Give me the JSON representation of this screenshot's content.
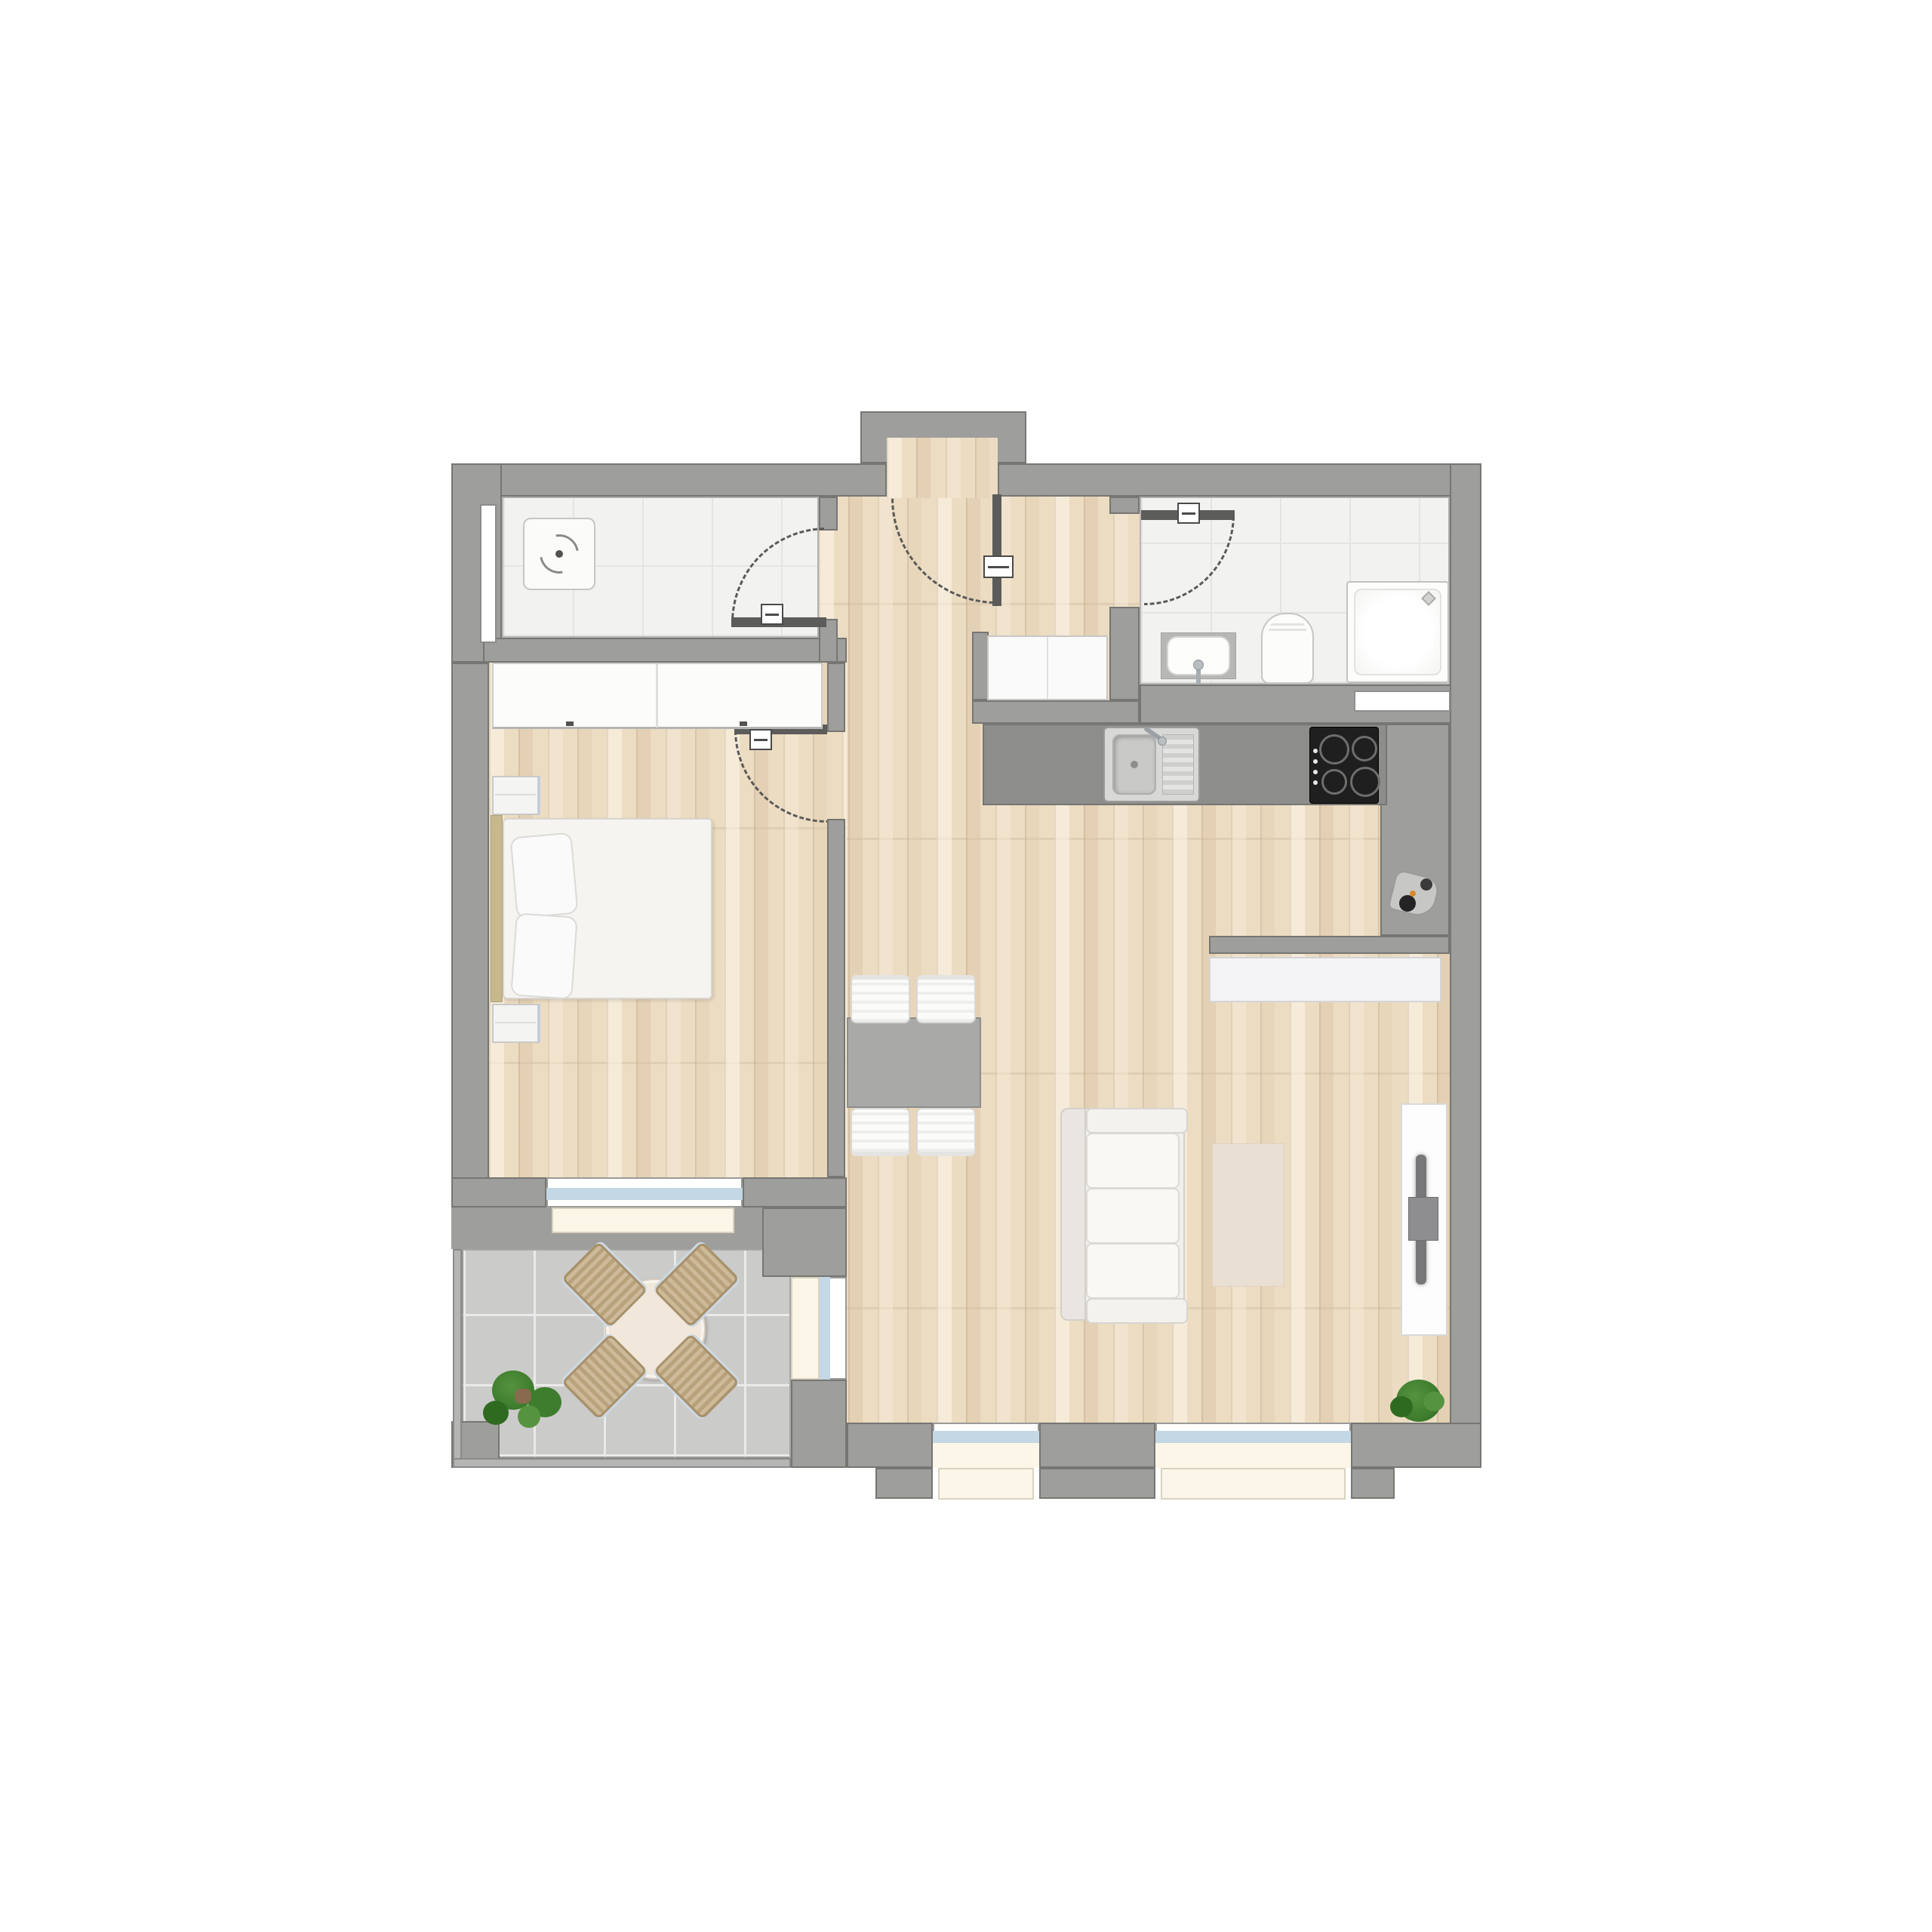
{
  "scene": {
    "kind": "apartment-floor-plan",
    "view": "top-down",
    "text_visible": false
  },
  "colors": {
    "background": "#ffffff",
    "wall": "#9e9e9c",
    "wall_outline": "#767672",
    "wood": "#ecdcc2",
    "tile": "#f2f2f1",
    "tile_grid": "#e4e4e2",
    "balcony_tile": "#cbcbc9",
    "balcony_grout": "#eaeaea",
    "counter": "#8d8d8b",
    "door_leaf": "#5c5c5a",
    "glazing": "#c3d7e4",
    "sill": "#fbf6e8",
    "furniture_white": "#fbfbfa",
    "furniture_border": "#cfcfcd",
    "table_gray": "#a9a9a7",
    "rug": "#e9dfd3",
    "chair_tan": "#c2ab83",
    "plant_green": "#3e7d2d",
    "plant_dark": "#2f6a21",
    "plant_light": "#569340",
    "hob_black": "#1f1f1f",
    "steel": "#d8d8d6",
    "headboard": "#c7b88e"
  },
  "rooms": [
    {
      "id": "storage-room",
      "floor": "tile",
      "furniture": [
        "washing-machine"
      ],
      "features": [
        "wall-window-slot",
        "door-to-hall"
      ]
    },
    {
      "id": "bedroom",
      "floor": "wood",
      "furniture": [
        "wardrobe",
        "nightstand",
        "double-bed",
        "two-pillows",
        "nightstand"
      ],
      "features": [
        "door-to-hall",
        "balcony-window-door"
      ]
    },
    {
      "id": "bathroom",
      "floor": "tile",
      "furniture": [
        "washbasin",
        "toilet",
        "shower"
      ],
      "features": [
        "door-to-hall",
        "wall-shelf"
      ]
    },
    {
      "id": "hall",
      "floor": "wood",
      "furniture": [
        "entry-closet"
      ],
      "features": [
        "entrance-door",
        "vestibule"
      ]
    },
    {
      "id": "kitchen",
      "floor": "wood",
      "furniture": [
        "counter",
        "sink-with-drainboard",
        "hob-4-burners",
        "corner-appliance"
      ]
    },
    {
      "id": "living-dining",
      "floor": "wood",
      "furniture": [
        "dining-table",
        "dining-chair",
        "dining-chair",
        "dining-chair",
        "dining-chair",
        "sofa-3-seat",
        "rug",
        "sideboard",
        "tv-sideboard",
        "tv",
        "plant"
      ],
      "features": [
        "balcony-door",
        "window",
        "window"
      ]
    },
    {
      "id": "balcony",
      "floor": "balcony-tile",
      "furniture": [
        "round-table",
        "balcony-chair",
        "balcony-chair",
        "balcony-chair",
        "balcony-chair",
        "plant"
      ]
    }
  ],
  "doors": [
    {
      "id": "entrance-door",
      "swing": "into-hall"
    },
    {
      "id": "storage-door",
      "swing": "into-storage-room"
    },
    {
      "id": "bedroom-door",
      "swing": "into-bedroom"
    },
    {
      "id": "bathroom-door",
      "swing": "into-bathroom"
    }
  ]
}
